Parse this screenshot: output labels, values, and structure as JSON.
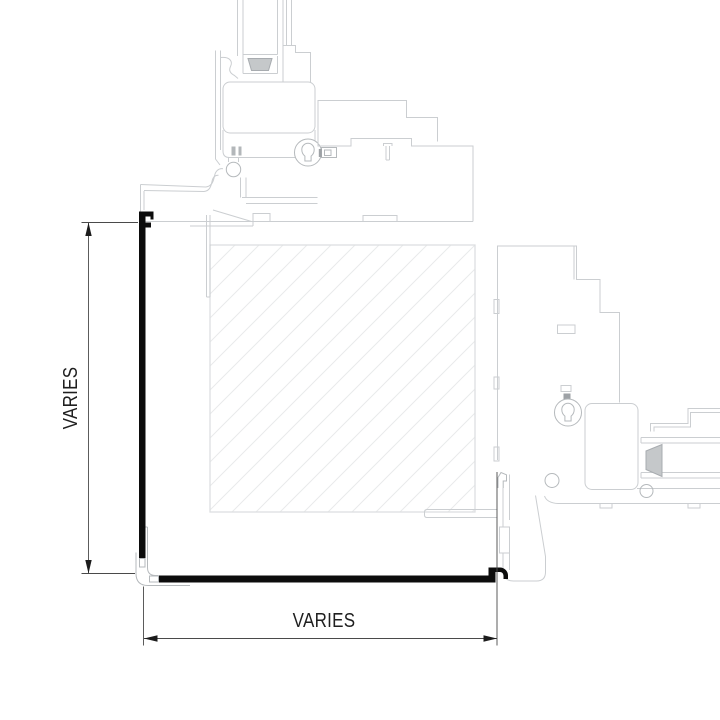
{
  "drawing": {
    "type": "window-corner-detail-section",
    "dimensions": {
      "vertical_label": "VARIES",
      "horizontal_label": "VARIES"
    },
    "components": {
      "top_section": "head-sill-frame-extrusion",
      "right_section": "jamb-frame-extrusion",
      "hatch_panel": "glazing-infill-panel",
      "black_profile": "corner-closure-trim"
    },
    "colors": {
      "background": "#ffffff",
      "profile_light": "#cbced1",
      "profile_mid": "#b5b9bc",
      "hatch_line": "#e9eaeb",
      "hatch_border": "#dddfe1",
      "closure_black": "#0c0c0c",
      "dimension_line": "#4a4a4a",
      "dimension_text": "#1f1f1f"
    }
  }
}
